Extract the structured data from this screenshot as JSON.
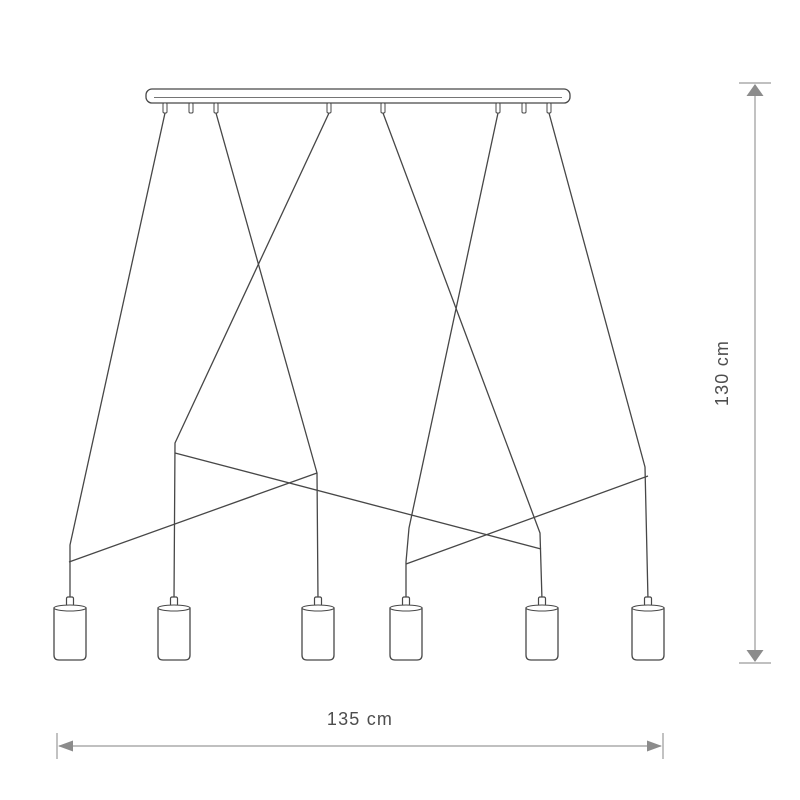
{
  "page": {
    "background": "#ffffff",
    "width": 800,
    "height": 800
  },
  "diagram": {
    "kind": "product-dimension-drawing",
    "subject": "six-light linear pendant lamp with crossed suspension cords",
    "colors": {
      "outline": "#474747",
      "dimension_line": "#9a9a9a",
      "arrowhead": "#8c8c8c",
      "label_text": "#4d4d4d",
      "fill": "#ffffff"
    },
    "canopy": {
      "x": 146,
      "y": 89,
      "width": 424,
      "height": 14,
      "corner_radius": 6,
      "inner_line": {
        "x1": 154,
        "x2": 562,
        "y": 97.5
      }
    },
    "connectors": {
      "y": 103,
      "width": 4,
      "height": 10,
      "positions_x": [
        165,
        191,
        216,
        329,
        383,
        498,
        524,
        549
      ]
    },
    "cords": [
      {
        "id": "cord-1",
        "points": [
          [
            165,
            113
          ],
          [
            70,
            545
          ],
          [
            70,
            600
          ]
        ]
      },
      {
        "id": "cord-2",
        "points": [
          [
            216,
            113
          ],
          [
            317,
            473
          ],
          [
            318,
            600
          ]
        ]
      },
      {
        "id": "cord-3",
        "points": [
          [
            329,
            113
          ],
          [
            175,
            443
          ],
          [
            174,
            600
          ]
        ]
      },
      {
        "id": "cord-4",
        "points": [
          [
            383,
            113
          ],
          [
            540,
            533
          ],
          [
            542,
            600
          ]
        ]
      },
      {
        "id": "cord-5",
        "points": [
          [
            498,
            113
          ],
          [
            409,
            528
          ],
          [
            406,
            562
          ],
          [
            406,
            600
          ]
        ]
      },
      {
        "id": "cord-6",
        "points": [
          [
            549,
            113
          ],
          [
            645,
            467
          ],
          [
            648,
            600
          ]
        ]
      }
    ],
    "cross_cords": [
      {
        "id": "cross-cord-1",
        "points": [
          [
            175,
            453
          ],
          [
            541,
            549
          ]
        ]
      },
      {
        "id": "cross-cord-2",
        "points": [
          [
            69,
            562
          ],
          [
            317,
            473
          ]
        ]
      },
      {
        "id": "cross-cord-3",
        "points": [
          [
            406,
            564
          ],
          [
            648,
            476
          ]
        ]
      }
    ],
    "shades": {
      "positions_x": [
        70,
        174,
        318,
        406,
        542,
        648
      ],
      "top_y": 606,
      "width": 32,
      "height": 54,
      "rim_ry": 3,
      "nipple": {
        "width": 7,
        "height": 9
      }
    },
    "dimensions": {
      "width": {
        "label": "135 cm",
        "x1": 57,
        "x2": 663,
        "y": 746,
        "tick_half": 13,
        "label_offset": 21
      },
      "height": {
        "label": "130 cm",
        "x": 755,
        "y1": 83,
        "y2": 663,
        "tick_half": 16,
        "label_offset": 27
      }
    }
  }
}
